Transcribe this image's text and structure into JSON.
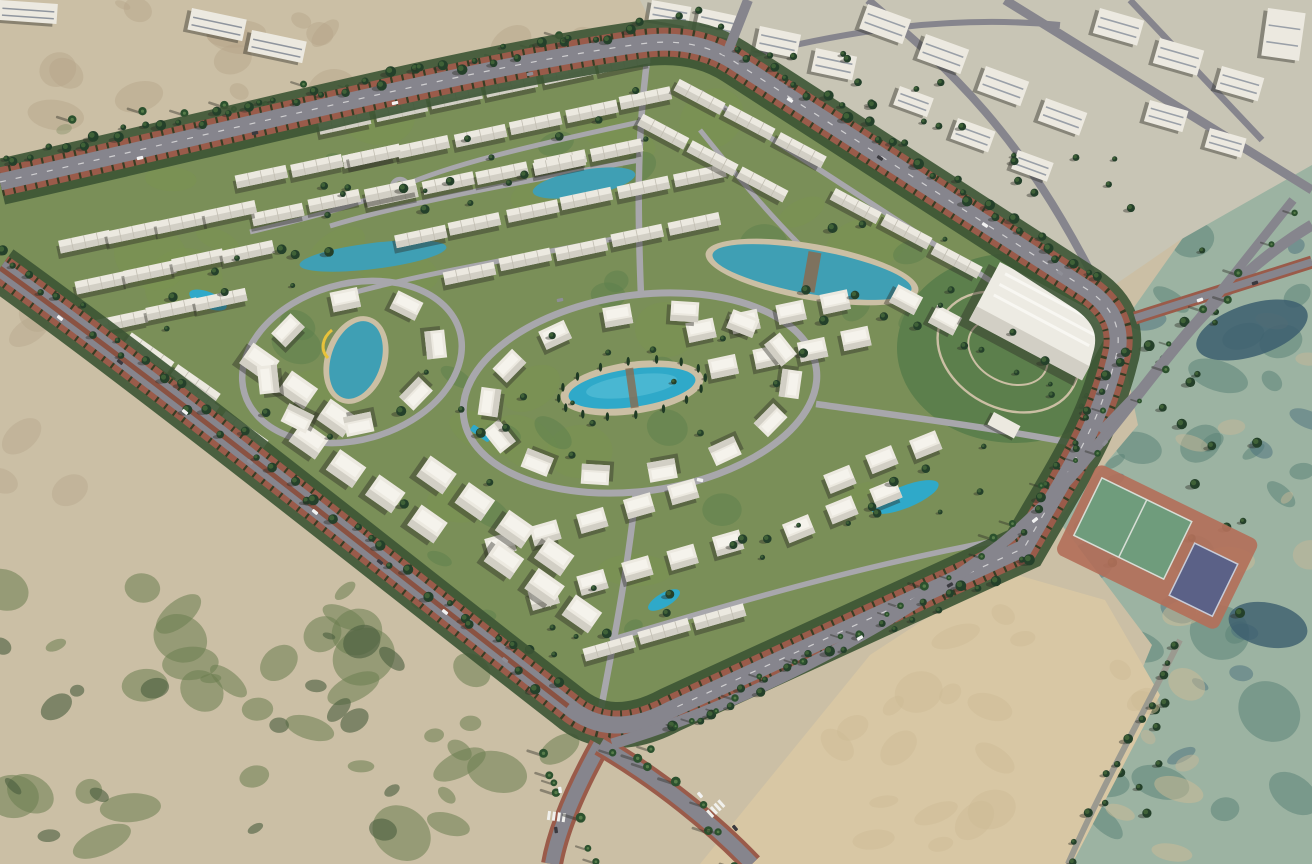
{
  "meta": {
    "title": "Aerial master-plan rendering of a gated residential compound",
    "image_type": "photorealistic 3D render, bird's-eye view",
    "visible_text": "none"
  },
  "palette": {
    "sand": "#cbbfa5",
    "sandDark": "#b5a489",
    "sandBright": "#d8c7a4",
    "scrub": "#6b7d51",
    "treeDark": "#24402a",
    "treeMid": "#3f6137",
    "grass": "#7a944f",
    "grassDark": "#5c7f4c",
    "roadAsphalt": "#86858d",
    "roadLight": "#a8a7ac",
    "sidewalkRed": "#9a5b4a",
    "medianRed": "#8a5242",
    "poolBlue": "#2fa9c9",
    "lagoonBlue": "#3f9fb4",
    "poolDeck": "#cbbfa4",
    "villaWhite": "#ece9e0",
    "villaShade": "#d2cfc5",
    "villaRoof": "#f5f3ec",
    "wetland": "#9cb3a2",
    "wetlandDark": "#5d8478",
    "wetlandBlue": "#3c5e6e",
    "urbanGround": "#c8c5b5",
    "courtGreen": "#6f9c7c",
    "courtRed": "#b3705a",
    "courtBlue": "#5b6187"
  },
  "scene": {
    "setting": "desert coastal plain",
    "features": [
      {
        "name": "residential-compound",
        "description": "diamond-shaped gated community of white villas and townhouses with green landscaping"
      },
      {
        "name": "central-pool",
        "description": "large oval turquoise pool ringed by villas and cypress trees"
      },
      {
        "name": "lagoon-pools",
        "description": "crescent and linear lagoon-style pools threaded between townhouse rows"
      },
      {
        "name": "left-lake",
        "description": "small lake with yellow slide path in west cluster"
      },
      {
        "name": "clubhouse",
        "description": "large flat-roofed white building in landscaped park near east corner"
      },
      {
        "name": "entrance-gate",
        "description": "white gatehouse on the south-east access road"
      },
      {
        "name": "tennis-courts",
        "description": "two green courts and one dark blue court on red-clay apron, outside the south-east edge"
      },
      {
        "name": "perimeter-boulevard",
        "description": "tree-lined dual carriageway with red median and sidewalks around the compound"
      },
      {
        "name": "north-district",
        "description": "neighbouring apartment district with streets at the top of the frame"
      },
      {
        "name": "wetland-east",
        "description": "teal-green salt marsh and lagoons along the right edge"
      },
      {
        "name": "desert-scrub",
        "description": "sand and scrub vegetation on the west and south"
      },
      {
        "name": "palm-trees",
        "description": "palms casting long shadows along the southern access roads"
      },
      {
        "name": "cars",
        "description": "scattered vehicles on the boulevards"
      }
    ],
    "approx_counts": {
      "villas_and_townhouses": 120,
      "pools": 9,
      "tennis_courts": 3
    }
  }
}
